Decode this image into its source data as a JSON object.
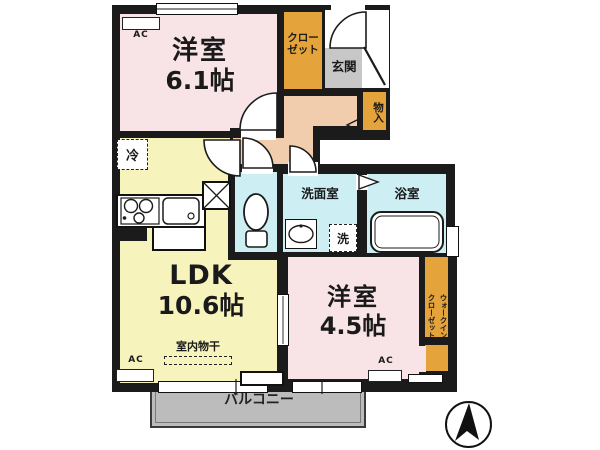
{
  "plan": {
    "bedroom1": {
      "name": "洋室",
      "size": "6.1帖"
    },
    "bedroom2": {
      "name": "洋室",
      "size": "4.5帖"
    },
    "ldk": {
      "name": "LDK",
      "size": "10.6帖"
    },
    "closet": {
      "line1": "クロー",
      "line2": "ゼット"
    },
    "walkin": {
      "line1": "ウォークイン",
      "line2": "クローゼット"
    },
    "entrance": "玄関",
    "storage": "物入",
    "washroom": "洗面室",
    "bathroom": "浴室",
    "fridge": "冷",
    "washer": "洗",
    "drying": "室内物干",
    "balcony": "バルコニー",
    "ac": "AC",
    "colors": {
      "wall": "#1b1b1b",
      "bedroom": "#f8e3e7",
      "ldk": "#f7f3bd",
      "closet": "#e5a33b",
      "hallway": "#f2cdad",
      "entrance_floor": "#c7c7c7",
      "wet_area": "#cdeef3",
      "balcony": "#bcbcbc"
    }
  }
}
